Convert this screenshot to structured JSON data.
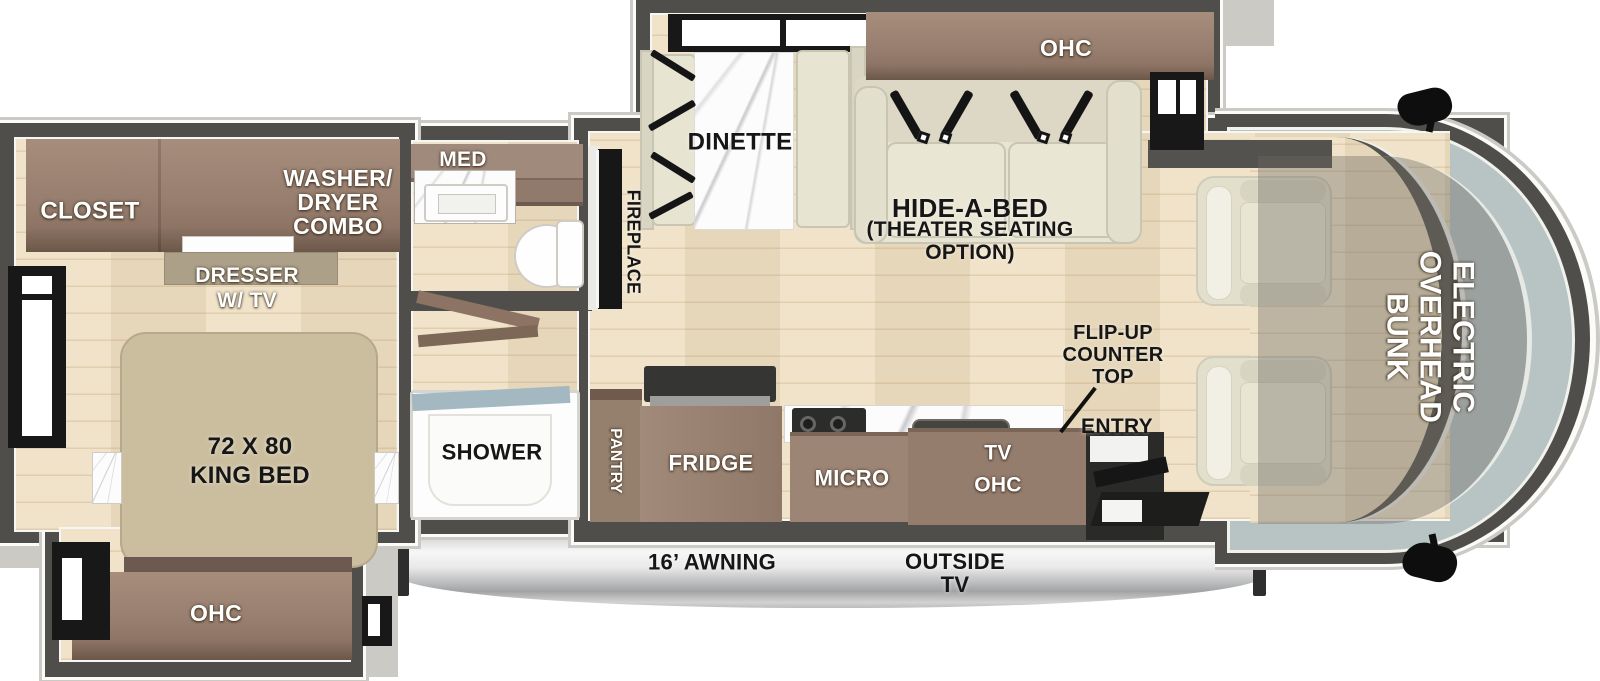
{
  "colors": {
    "wall": "#4f4e4b",
    "trim": "#cbcac5",
    "floor": "#eee0c4",
    "cabinet": "#967d6e",
    "cabinet-dark": "#6d5a4e",
    "kitchen-cabinet": "#9c8577",
    "cushion": "#e8e4d2",
    "bed": "#cbbe9f",
    "marble": "#fcfcfc",
    "glass": "#b7c4c3",
    "shower-rim": "#a3b8c0",
    "entry-dark": "#2a2a28",
    "label-white": "#ffffff",
    "label-black": "#161616"
  },
  "bedroom": {
    "closet": "CLOSET",
    "washer_dryer": "WASHER/\nDRYER\nCOMBO",
    "dresser": "DRESSER\nW/ TV",
    "king_bed": "72 X 80\nKING BED",
    "ohc": "OHC"
  },
  "bathroom": {
    "med": "MED",
    "shower": "SHOWER"
  },
  "living": {
    "dinette": "DINETTE",
    "ohc": "OHC",
    "hide_a_bed": "HIDE-A-BED",
    "hide_a_bed_option": "(THEATER SEATING\nOPTION)",
    "fireplace": "FIREPLACE"
  },
  "kitchen": {
    "pantry": "PANTRY",
    "fridge": "FRIDGE",
    "micro": "MICRO",
    "tv_ohc": "TV\nOHC",
    "flip_up_counter": "FLIP-UP\nCOUNTER\nTOP",
    "entry": "ENTRY"
  },
  "cab": {
    "overhead_bunk": "ELECTRIC\nOVERHEAD\nBUNK"
  },
  "exterior": {
    "awning": "16’ AWNING",
    "outside_tv": "OUTSIDE\nTV"
  }
}
